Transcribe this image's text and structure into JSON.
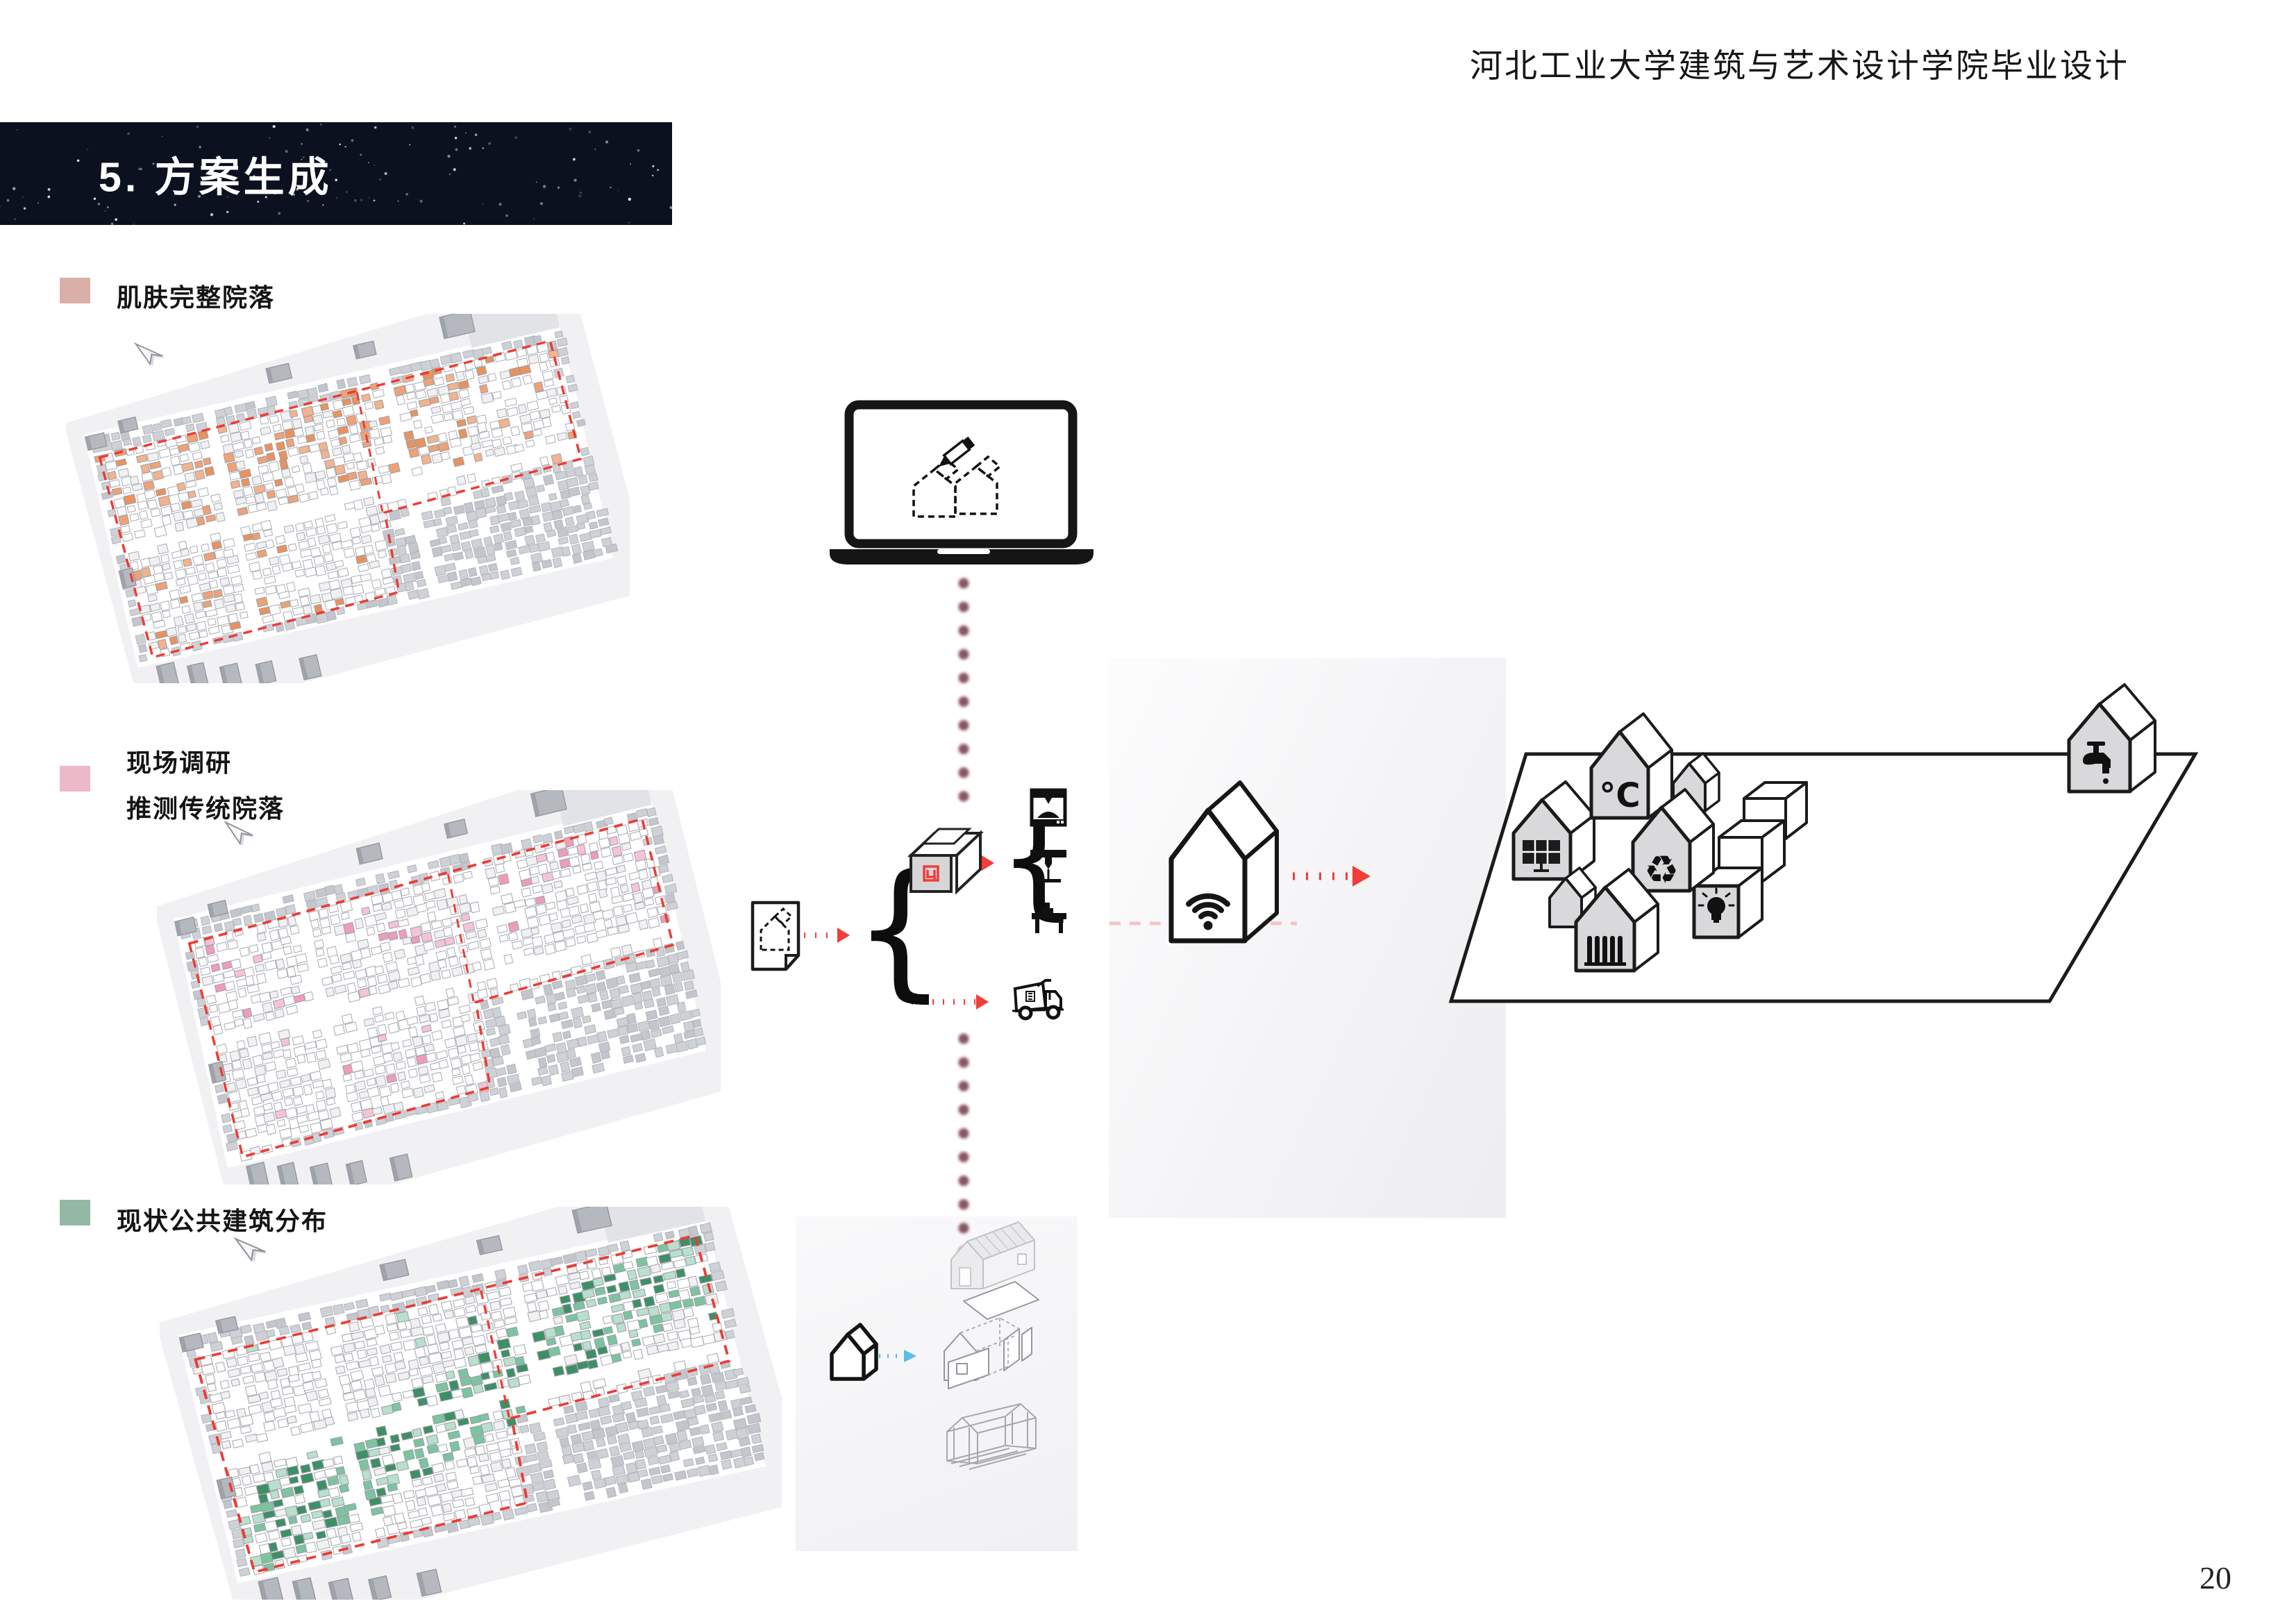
{
  "page": {
    "header": "河北工业大学建筑与艺术设计学院毕业设计",
    "page_number": "20"
  },
  "banner": {
    "title": "5. 方案生成",
    "background": "#0c1120",
    "text_color": "#ffffff"
  },
  "legend": {
    "items": [
      {
        "label": "肌肤完整院落",
        "swatch_color": "#d9afa8"
      },
      {
        "label_line1": "现场调研",
        "label_line2": "推测传统院落",
        "swatch_color": "#ecb9c9"
      },
      {
        "label": "现状公共建筑分布",
        "swatch_color": "#93b8a5"
      }
    ]
  },
  "maps": [
    {
      "name": "skin-intact-courtyards",
      "highlight_mode": "cluster",
      "highlight_colors": [
        "#e8935f",
        "#f2b38e",
        "#eda277"
      ],
      "boundary_color": "#ee3b33",
      "seed": 7
    },
    {
      "name": "surveyed-traditional-courtyards",
      "highlight_mode": "sparse",
      "highlight_colors": [
        "#ef9cba",
        "#f6c3d6"
      ],
      "boundary_color": "#ee3b33",
      "seed": 13
    },
    {
      "name": "existing-public-buildings",
      "highlight_mode": "band",
      "highlight_colors": [
        "#3f8f66",
        "#7cc4a0",
        "#b9e0cd"
      ],
      "boundary_color": "#ee3b33",
      "seed": 21
    }
  ],
  "flow": {
    "arrow_color": "#f23d38",
    "dot_color": "#7c4350",
    "blue_arrow_color": "#56bfe3",
    "faint_dash_color": "#f59a97",
    "brace": "{",
    "temperature_label": "°C",
    "recycle_symbol": "♻"
  },
  "platform": {
    "utilities": [
      "solar-power",
      "temperature",
      "recycling",
      "heating",
      "lighting",
      "water-supply"
    ]
  }
}
